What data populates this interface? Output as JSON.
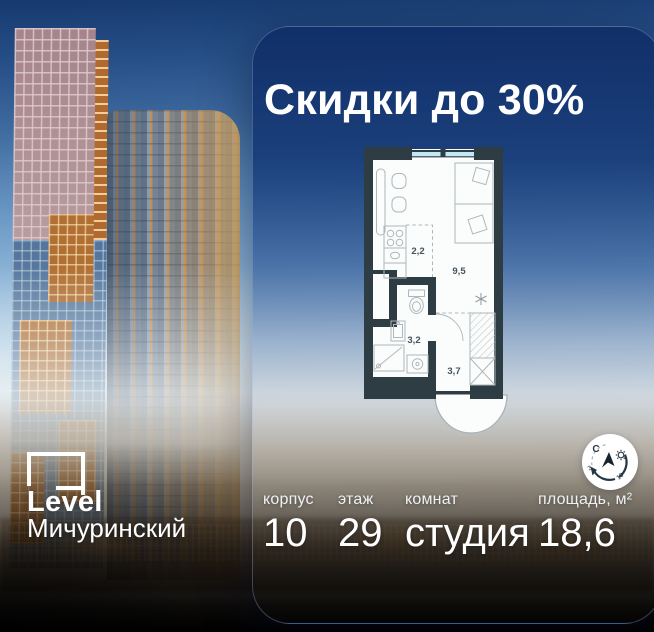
{
  "card": {
    "title": "Скидки до 30%"
  },
  "floorplan": {
    "room_areas": {
      "kitchen": "2,2",
      "living": "9,5",
      "bathroom": "3,2",
      "hallway": "3,7"
    }
  },
  "compass": {
    "north_label": "С",
    "sun_start_hour": "3",
    "sun_end_hour": "10"
  },
  "specs": [
    {
      "label": "корпус",
      "value": "10"
    },
    {
      "label": "этаж",
      "value": "29"
    },
    {
      "label": "комнат",
      "value": "студия"
    },
    {
      "label": "площадь, м²",
      "value": "18,6"
    }
  ],
  "brand": {
    "name": "Level",
    "project": "Мичуринский"
  },
  "colors": {
    "card_top": "#112f68",
    "title_text": "#ffffff",
    "plan_walls": "#2e3c43",
    "plan_window_glass": "#c2e7f5",
    "accent_orange": "#b06f33",
    "facade_blue": "#5e7fa3"
  }
}
